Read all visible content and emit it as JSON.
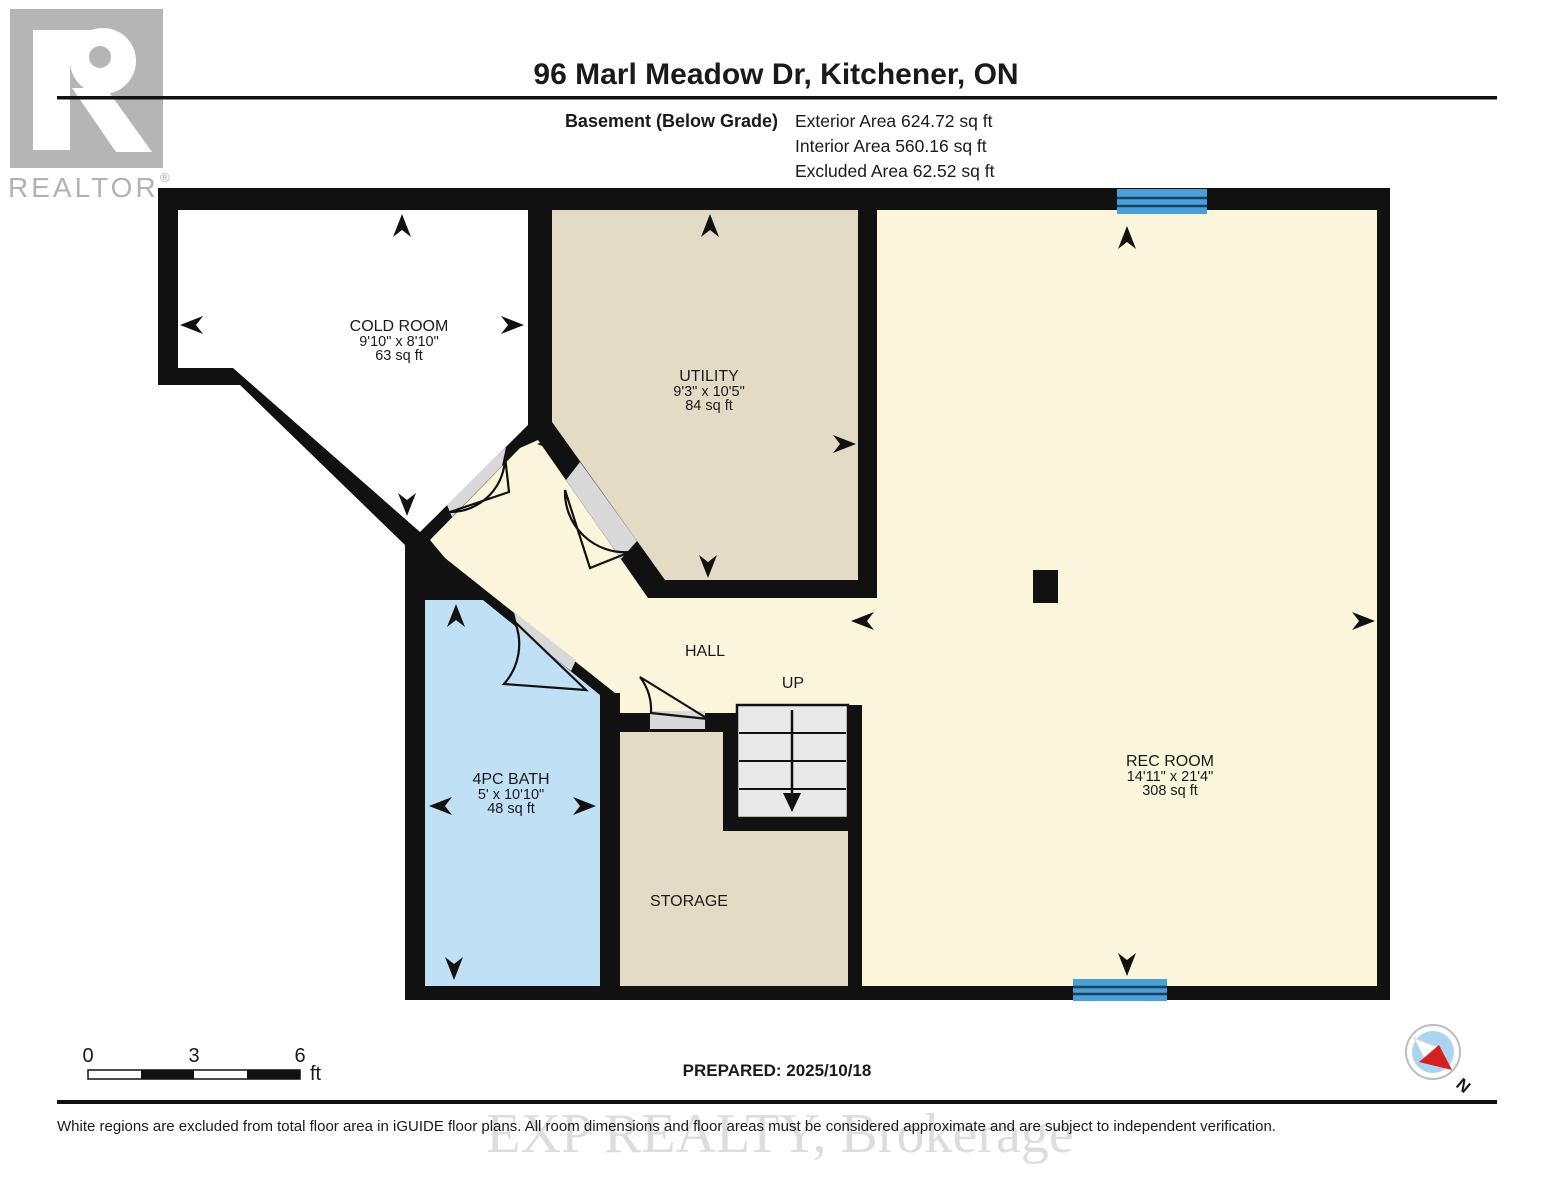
{
  "header": {
    "title": "96 Marl Meadow Dr, Kitchener, ON",
    "floor_label": "Basement (Below Grade)",
    "areas": [
      "Exterior Area 624.72 sq ft",
      "Interior Area 560.16 sq ft",
      "Excluded Area 62.52 sq ft"
    ]
  },
  "branding": {
    "realtor": "REALTOR",
    "reg": "®"
  },
  "rooms": {
    "cold_room": {
      "name": "COLD ROOM",
      "dims": "9'10\" x 8'10\"",
      "area": "63 sq ft"
    },
    "utility": {
      "name": "UTILITY",
      "dims": "9'3\" x 10'5\"",
      "area": "84 sq ft"
    },
    "rec_room": {
      "name": "REC ROOM",
      "dims": "14'11\" x 21'4\"",
      "area": "308 sq ft"
    },
    "bath": {
      "name": "4PC BATH",
      "dims": "5' x 10'10\"",
      "area": "48 sq ft"
    },
    "hall": {
      "name": "HALL"
    },
    "storage": {
      "name": "STORAGE"
    },
    "stairs": {
      "direction": "UP"
    }
  },
  "scale_bar": {
    "t0": "0",
    "t3": "3",
    "t6": "6",
    "unit": "ft"
  },
  "compass": {
    "north": "N"
  },
  "footer": {
    "prepared": "PREPARED: 2025/10/18",
    "disclaimer": "White regions are excluded from total floor area in iGUIDE floor plans. All room dimensions and floor areas must be considered approximate and are subject to independent verification.",
    "watermark": "EXP REALTY, Brokerage"
  },
  "colors": {
    "wall": "#111111",
    "floor_cream": "#fbf5dc",
    "floor_beige": "#e3dbc6",
    "bath_blue": "#bfe0f5",
    "window_blue": "#4aa0d6",
    "window_line": "#1b3f63",
    "door_gray": "#d9d9d9",
    "stairs_gray": "#e9e9e9",
    "logo_gray": "#b5b5b5"
  }
}
